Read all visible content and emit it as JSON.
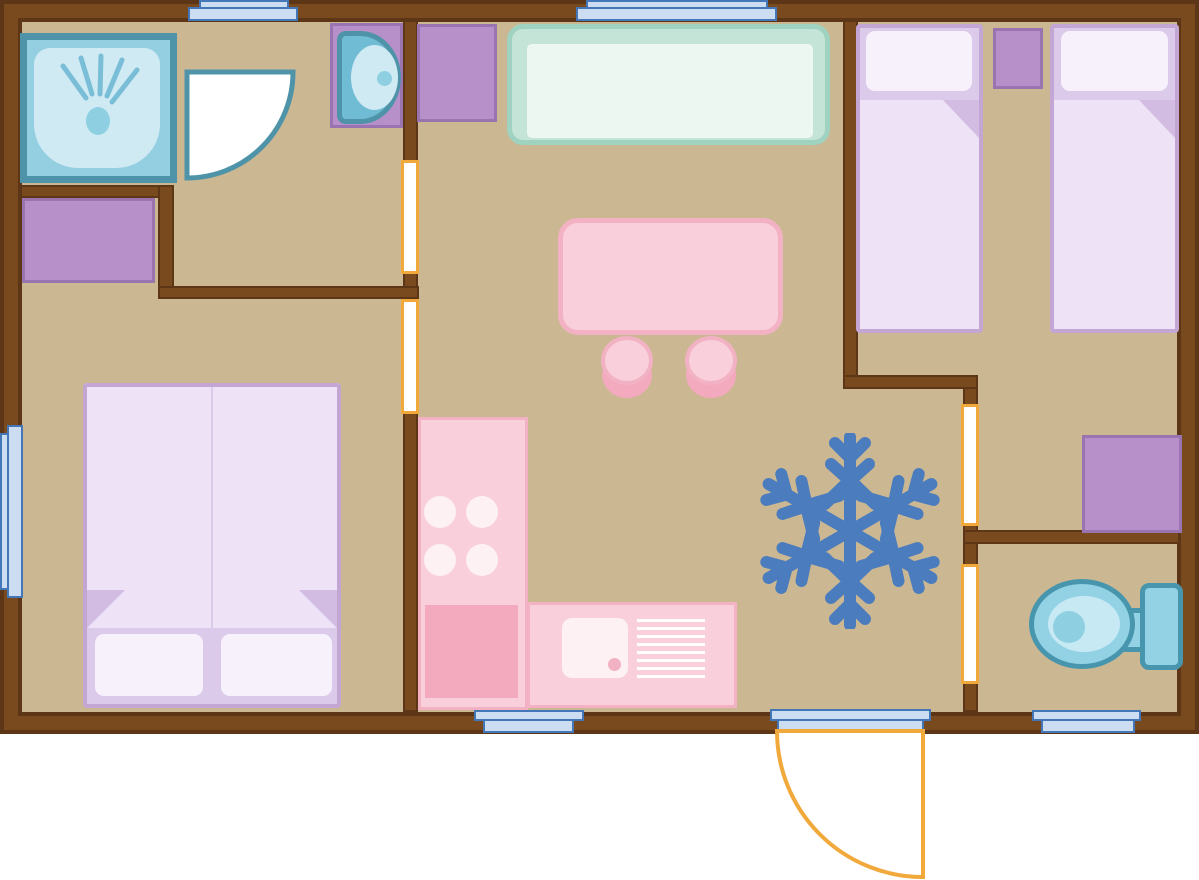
{
  "plan": {
    "type": "mobile-home floor plan, top view, no text labels",
    "rooms": [
      {
        "id": "bathroom",
        "position": "top-left",
        "furniture": [
          "shower",
          "shower-door",
          "washbasin-vanity",
          "bathroom-cabinet"
        ]
      },
      {
        "id": "living-kitchen",
        "position": "center",
        "furniture": [
          "sofa",
          "hall-cabinet",
          "dining-table",
          "stool-left",
          "stool-right",
          "kitchen-tall-unit",
          "kitchen-counter",
          "snowflake-symbol"
        ]
      },
      {
        "id": "bedroom-left",
        "position": "bottom-left",
        "furniture": [
          "double-bed"
        ]
      },
      {
        "id": "bedroom-right",
        "position": "top-right",
        "furniture": [
          "single-bed-left",
          "nightstand",
          "single-bed-right",
          "wardrobe"
        ]
      },
      {
        "id": "wc",
        "position": "bottom-right",
        "furniture": [
          "toilet"
        ]
      }
    ],
    "windows": [
      "window-top-left",
      "window-top-center",
      "window-left",
      "window-bottom-kitchen",
      "window-bottom-right"
    ],
    "doors": [
      "entrance-door-bottom",
      "door-opening-bathroom",
      "door-opening-hall",
      "door-opening-bedroom-right",
      "door-opening-toilet",
      "shower-door"
    ]
  },
  "colors": {
    "wall_fill": "#7a4a1f",
    "wall_outline": "#5d3517",
    "floor": "#cbb893",
    "teal_border": "#4f93a9",
    "water_blue": "#93cfe1",
    "water_light": "#cfeaf3",
    "basin_blue": "#6fbcd4",
    "spray_blue": "#79bed6",
    "dot_blue": "#8ed0e2",
    "purple_fill": "#b790c9",
    "purple_border": "#9a74b0",
    "bed_base": "#dccaea",
    "bed_duvet": "#eee3f6",
    "bed_pillow": "#f7f1fb",
    "bed_fold": "#d2bce2",
    "bed_border": "#c3a6d3",
    "sofa_border": "#9fd2c0",
    "sofa_fill": "#c3e4d6",
    "sofa_inner": "#edf7f2",
    "pink_fill": "#f8cfdb",
    "pink_border": "#f2b2c4",
    "pink_dark": "#f3a9be",
    "pink_pale": "#fdf1f4",
    "window_fill": "#ccdcf1",
    "window_border": "#4377b8",
    "door_yellow": "#f2a93b",
    "snowflake_blue": "#4b7cbd",
    "toilet_fill": "#93d2e4",
    "toilet_border": "#4896ad",
    "toilet_inner": "#c7e9f3"
  }
}
